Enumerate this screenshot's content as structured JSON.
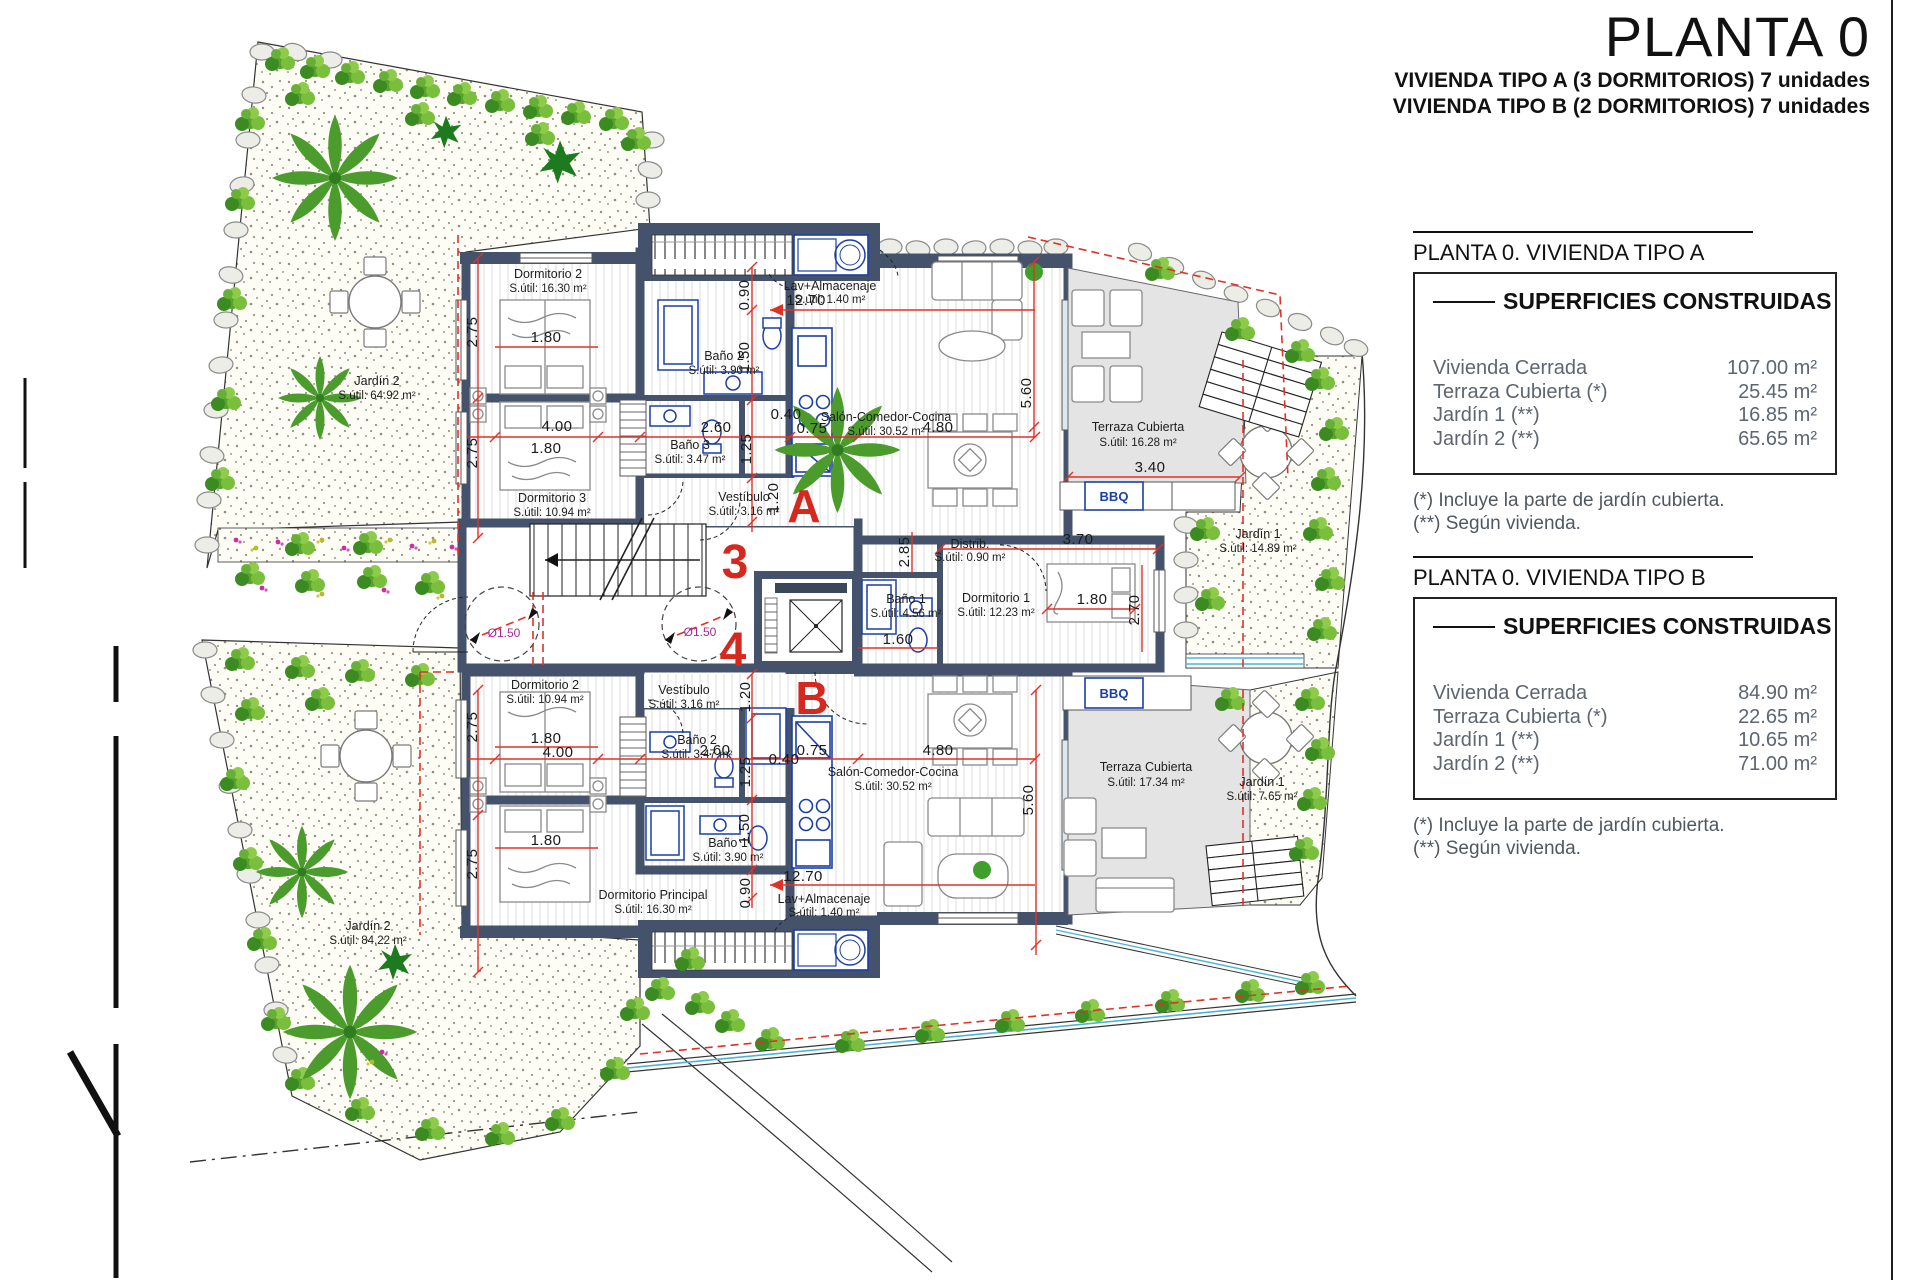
{
  "sheet": {
    "title": "PLANTA 0",
    "subtitle_line1": "VIVIENDA TIPO A (3 DORMITORIOS) 7 unidades",
    "subtitle_line2": "VIVIENDA TIPO B (2 DORMITORIOS) 7 unidades"
  },
  "summary_a": {
    "header": "PLANTA 0. VIVIENDA TIPO A",
    "table_title": "SUPERFICIES CONSTRUIDAS",
    "rows": [
      {
        "label": "Vivienda Cerrada",
        "value": "107.00 m²"
      },
      {
        "label": "Terraza Cubierta  (*)",
        "value": "25.45 m²"
      },
      {
        "label": "Jardín 1 (**)",
        "value": "16.85 m²"
      },
      {
        "label": "Jardín 2 (**)",
        "value": "65.65 m²"
      }
    ],
    "note1": "(*)  Incluye la parte de jardín cubierta.",
    "note2": "(**) Según vivienda."
  },
  "summary_b": {
    "header": "PLANTA 0. VIVIENDA TIPO B",
    "table_title": "SUPERFICIES CONSTRUIDAS",
    "rows": [
      {
        "label": "Vivienda Cerrada",
        "value": "84.90 m²"
      },
      {
        "label": "Terraza Cubierta (*)",
        "value": "22.65 m²"
      },
      {
        "label": "Jardín 1 (**)",
        "value": "10.65 m²"
      },
      {
        "label": "Jardín 2 (**)",
        "value": "71.00 m²"
      }
    ],
    "note1": "(*) Incluye la parte de jardín cubierta.",
    "note2": "(**) Según vivienda."
  },
  "plan": {
    "units": {
      "a": "A",
      "b": "B",
      "stair_up": "3",
      "stair_down": "4"
    },
    "rooms_a": {
      "dorm2": {
        "name": "Dormitorio 2",
        "area": "S.útil: 16.30 m²"
      },
      "dorm3": {
        "name": "Dormitorio 3",
        "area": "S.útil: 10.94 m²"
      },
      "bano2": {
        "name": "Baño 2",
        "area": "S.útil: 3.90 m²"
      },
      "bano3": {
        "name": "Baño 3",
        "area": "S.útil: 3.47 m²"
      },
      "vestibulo": {
        "name": "Vestíbulo",
        "area": "S.útil: 3.16 m²"
      },
      "lavadero": {
        "name": "Lav+Almacenaje",
        "area": "S.útil: 1.40 m²"
      },
      "salon": {
        "name": "Salón-Comedor-Cocina",
        "area": "S.útil: 30.52 m²"
      },
      "distribuidor": {
        "name": "Distrib.",
        "area": "S.útil: 0.90 m²"
      },
      "bano1": {
        "name": "Baño 1",
        "area": "S.útil: 4.56 m²"
      },
      "dorm1": {
        "name": "Dormitorio 1",
        "area": "S.útil: 12.23 m²"
      },
      "terraza": {
        "name": "Terraza Cubierta",
        "area": "S.útil: 16.28 m²"
      },
      "jardin1": {
        "name": "Jardín 1",
        "area": "S.útil: 14.89 m²"
      },
      "jardin2": {
        "name": "Jardín 2",
        "area": "S.útil: 64.92 m²"
      }
    },
    "rooms_b": {
      "dorm2": {
        "name": "Dormitorio 2",
        "area": "S.útil: 10.94 m²"
      },
      "vestibulo": {
        "name": "Vestíbulo",
        "area": "S.útil: 3.16 m²"
      },
      "bano2": {
        "name": "Baño 2",
        "area": "S.útil: 3.47 m²"
      },
      "bano1": {
        "name": "Baño 1",
        "area": "S.útil: 3.90 m²"
      },
      "dormp": {
        "name": "Dormitorio Principal",
        "area": "S.útil: 16.30 m²"
      },
      "lavadero": {
        "name": "Lav+Almacenaje",
        "area": "S.útil: 1.40 m²"
      },
      "salon": {
        "name": "Salón-Comedor-Cocina",
        "area": "S.útil: 30.52 m²"
      },
      "terraza": {
        "name": "Terraza Cubierta",
        "area": "S.útil: 17.34 m²"
      },
      "jardin1": {
        "name": "Jardín 1",
        "area": "S.útil: 7.65 m²"
      },
      "jardin2": {
        "name": "Jardín 2",
        "area": "S.útil: 84.22 m²"
      }
    },
    "labels": {
      "bbq": "BBQ",
      "diameter": "Ø1.50"
    },
    "dims": {
      "d040": "0.40",
      "d075": "0.75",
      "d090": "0.90",
      "d120": "1.20",
      "d125": "1.25",
      "d150": "1.50",
      "d160": "1.60",
      "d180": "1.80",
      "d260": "2.60",
      "d270": "2.70",
      "d275": "2.75",
      "d285": "2.85",
      "d340": "3.40",
      "d370": "3.70",
      "d400": "4.00",
      "d480": "4.80",
      "d560": "5.60",
      "d1270": "12.70"
    },
    "colors": {
      "wall": "#44526b",
      "dimension": "#e03127",
      "unit_letter": "#d5281e",
      "fixture": "#1b3fa8",
      "diameter_label": "#a0289e",
      "terrace": "#e4e4e4"
    }
  }
}
